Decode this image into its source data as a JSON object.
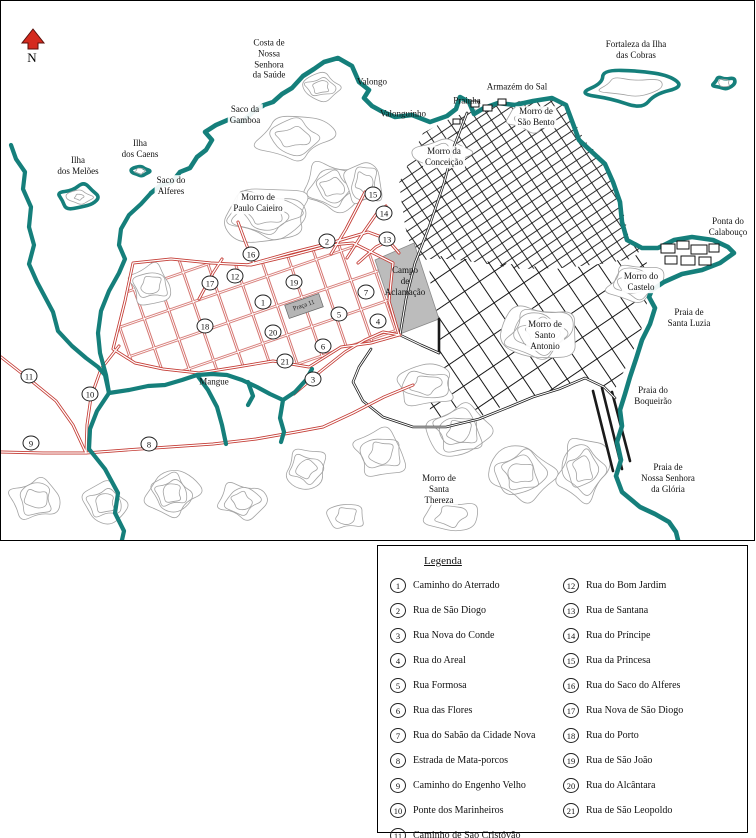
{
  "map": {
    "compass_label": "N",
    "colors": {
      "coast": "#157f7b",
      "new_roads": "#c43c35",
      "old_roads": "#1a1a1a",
      "contours": "#a3a3a3",
      "area_fill": "#bcbcbc",
      "compass": "#d42a1e"
    },
    "labels": [
      {
        "id": "costa-saude",
        "text": "Costa de\nNossa\nSenhora\nda Saúde",
        "x": 268,
        "y": 58
      },
      {
        "id": "valongo",
        "text": "Valongo",
        "x": 371,
        "y": 81
      },
      {
        "id": "valonguinho",
        "text": "Valonguinho",
        "x": 402,
        "y": 113
      },
      {
        "id": "prainha",
        "text": "Prainha",
        "x": 466,
        "y": 100
      },
      {
        "id": "armazem-do-sal",
        "text": "Armazém do Sal",
        "x": 516,
        "y": 86
      },
      {
        "id": "fortaleza-cobras",
        "text": "Fortaleza da Ilha\ndas Cobras",
        "x": 635,
        "y": 49
      },
      {
        "id": "morro-sao-bento",
        "text": "Morro de\nSão Bento",
        "x": 535,
        "y": 116,
        "bg": true
      },
      {
        "id": "morro-conceicao",
        "text": "Morro da\nConceição",
        "x": 443,
        "y": 156,
        "bg": true
      },
      {
        "id": "ponta-calabouco",
        "text": "Ponta do\nCalabouço",
        "x": 727,
        "y": 226
      },
      {
        "id": "ilha-meloes",
        "text": "Ilha\ndos Melões",
        "x": 77,
        "y": 165,
        "bg": true
      },
      {
        "id": "ilha-caens",
        "text": "Ilha\ndos Caens",
        "x": 139,
        "y": 148,
        "bg": true
      },
      {
        "id": "saco-gamboa",
        "text": "Saco da\nGamboa",
        "x": 244,
        "y": 114,
        "bg": true
      },
      {
        "id": "saco-alferes",
        "text": "Saco do\nAlferes",
        "x": 170,
        "y": 185,
        "bg": true
      },
      {
        "id": "morro-paulo-caieiro",
        "text": "Morro de\nPaulo Caieiro",
        "x": 257,
        "y": 202,
        "bg": true
      },
      {
        "id": "campo-aclamacao",
        "text": "Campo\nde\nAclamação",
        "x": 404,
        "y": 280
      },
      {
        "id": "praca-11",
        "text": "Praça 11",
        "x": 303,
        "y": 305,
        "rot": true
      },
      {
        "id": "mangue",
        "text": "Mangue",
        "x": 213,
        "y": 381
      },
      {
        "id": "morro-santo-antonio",
        "text": "Morro de\nSanto\nAntonio",
        "x": 544,
        "y": 334,
        "bg": true
      },
      {
        "id": "morro-castelo",
        "text": "Morro do\nCastelo",
        "x": 640,
        "y": 281,
        "bg": true
      },
      {
        "id": "praia-santa-luzia",
        "text": "Praia de\nSanta Luzia",
        "x": 688,
        "y": 317
      },
      {
        "id": "praia-boqueirao",
        "text": "Praia do\nBoqueirão",
        "x": 652,
        "y": 395
      },
      {
        "id": "praia-gloria",
        "text": "Praia de\nNossa Senhora\nda Glória",
        "x": 667,
        "y": 477
      },
      {
        "id": "morro-santa-thereza",
        "text": "Morro de\nSanta\nThereza",
        "x": 438,
        "y": 488,
        "bg": true
      }
    ],
    "markers": [
      {
        "n": "1",
        "x": 262,
        "y": 301
      },
      {
        "n": "2",
        "x": 326,
        "y": 240
      },
      {
        "n": "3",
        "x": 312,
        "y": 378
      },
      {
        "n": "4",
        "x": 377,
        "y": 320
      },
      {
        "n": "5",
        "x": 338,
        "y": 313
      },
      {
        "n": "6",
        "x": 322,
        "y": 345
      },
      {
        "n": "7",
        "x": 365,
        "y": 291
      },
      {
        "n": "8",
        "x": 148,
        "y": 443
      },
      {
        "n": "9",
        "x": 30,
        "y": 442
      },
      {
        "n": "10",
        "x": 89,
        "y": 393
      },
      {
        "n": "11",
        "x": 28,
        "y": 375
      },
      {
        "n": "12",
        "x": 234,
        "y": 275
      },
      {
        "n": "13",
        "x": 386,
        "y": 238
      },
      {
        "n": "14",
        "x": 383,
        "y": 212
      },
      {
        "n": "15",
        "x": 372,
        "y": 193
      },
      {
        "n": "16",
        "x": 250,
        "y": 253
      },
      {
        "n": "17",
        "x": 209,
        "y": 282
      },
      {
        "n": "18",
        "x": 204,
        "y": 325
      },
      {
        "n": "19",
        "x": 293,
        "y": 281
      },
      {
        "n": "20",
        "x": 272,
        "y": 331
      },
      {
        "n": "21",
        "x": 284,
        "y": 360
      }
    ]
  },
  "legend": {
    "title": "Legenda",
    "items": [
      {
        "n": "1",
        "label": "Caminho do Aterrado"
      },
      {
        "n": "2",
        "label": "Rua de São Diogo"
      },
      {
        "n": "3",
        "label": "Rua Nova do Conde"
      },
      {
        "n": "4",
        "label": "Rua do Areal"
      },
      {
        "n": "5",
        "label": "Rua Formosa"
      },
      {
        "n": "6",
        "label": "Rua das Flores"
      },
      {
        "n": "7",
        "label": "Rua do Sabão da Cidade Nova"
      },
      {
        "n": "8",
        "label": "Estrada de Mata-porcos"
      },
      {
        "n": "9",
        "label": "Caminho do Engenho Velho"
      },
      {
        "n": "10",
        "label": "Ponte dos Marinheiros"
      },
      {
        "n": "11",
        "label": "Caminho de Sao Cristóvão"
      },
      {
        "n": "12",
        "label": "Rua do Bom Jardim"
      },
      {
        "n": "13",
        "label": "Rua de Santana"
      },
      {
        "n": "14",
        "label": "Rua do Príncipe"
      },
      {
        "n": "15",
        "label": "Rua da Princesa"
      },
      {
        "n": "16",
        "label": "Rua do Saco do Alferes"
      },
      {
        "n": "17",
        "label": "Rua Nova de São Diogo"
      },
      {
        "n": "18",
        "label": "Rua do Porto"
      },
      {
        "n": "19",
        "label": "Rua de São João"
      },
      {
        "n": "20",
        "label": "Rua do Alcântara"
      },
      {
        "n": "21",
        "label": "Rua de São Leopoldo"
      }
    ]
  }
}
